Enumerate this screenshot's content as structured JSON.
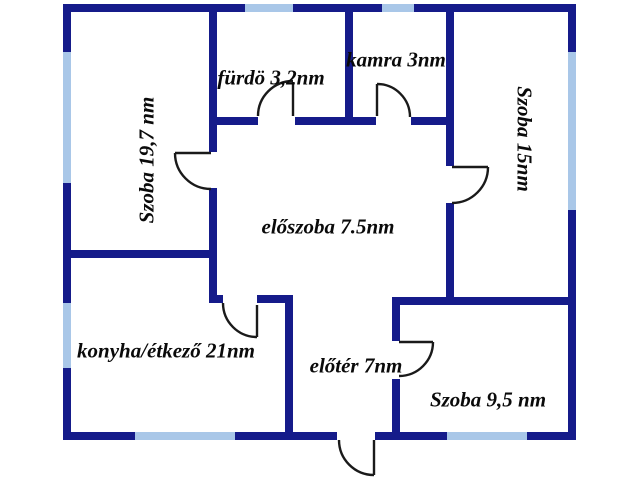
{
  "floorplan": {
    "colors": {
      "background": "#ffffff",
      "wall": "#151b8a",
      "window": "#a9c7e8",
      "door_line": "#1a1a1a",
      "label": "#0a0a0a"
    },
    "rooms": [
      {
        "id": "szoba-19-7",
        "label": "Szoba 19,7 nm"
      },
      {
        "id": "furdo",
        "label": "fürdö 3,2nm"
      },
      {
        "id": "kamra",
        "label": "kamra 3nm"
      },
      {
        "id": "szoba-15",
        "label": "Szoba 15nm"
      },
      {
        "id": "eloszoba",
        "label": "előszoba 7.5nm"
      },
      {
        "id": "konyha",
        "label": "konyha/étkező 21nm"
      },
      {
        "id": "eloter",
        "label": "előtér 7nm"
      },
      {
        "id": "szoba-95",
        "label": "Szoba 9,5 nm"
      }
    ]
  }
}
